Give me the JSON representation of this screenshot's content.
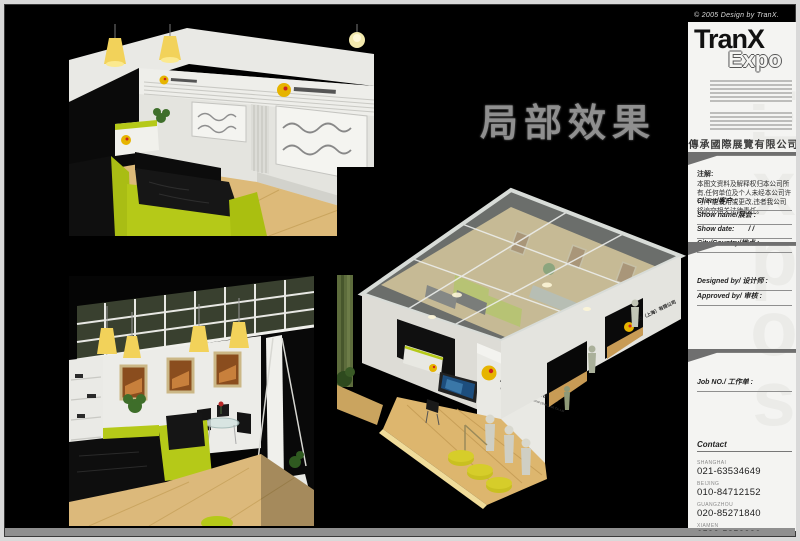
{
  "page": {
    "copyright": "© 2005 Design by TranX.",
    "title": "局部效果"
  },
  "booth": {
    "logo_cn": "触动（上海）有限公司",
    "logo_en": "China View Textile International (Shanghai) Co.,Ltd"
  },
  "sidebar": {
    "brand_line1": "TranX",
    "brand_line2": "Expo",
    "company": "傳承國際展覽有限公司",
    "note_heading": "注解:",
    "note_body": "本图文资料及解释权归本公司所有,任何单位及个人未经本公司许可,不能使用或更改,违者我公司将追究相关法律责任。",
    "fields": [
      {
        "label": "Client/客户 :"
      },
      {
        "label": "Show name/展会 :"
      },
      {
        "label": "Show date:"
      },
      {
        "label": "City/Country/地点 :"
      }
    ],
    "show_date_slashes": "/            /",
    "approval_fields": [
      {
        "label": "Designed by/ 设计师 :"
      },
      {
        "label": "Approved by/ 审核 :"
      }
    ],
    "job_label": "Job NO./ 工作单 :",
    "contact_heading": "Contact",
    "contacts": [
      {
        "city": "SHANGHAI",
        "phone": "021-63534649"
      },
      {
        "city": "BEIJING",
        "phone": "010-84712152"
      },
      {
        "city": "GUANGZHOU",
        "phone": "020-85271840"
      },
      {
        "city": "XIAMEN",
        "phone": "0592-5852230"
      }
    ],
    "watermark": "Expos"
  },
  "colors": {
    "accent_lime": "#b5c918",
    "logo_yellow": "#e6b400",
    "logo_red": "#cc2222",
    "wood": "#d9b878"
  }
}
